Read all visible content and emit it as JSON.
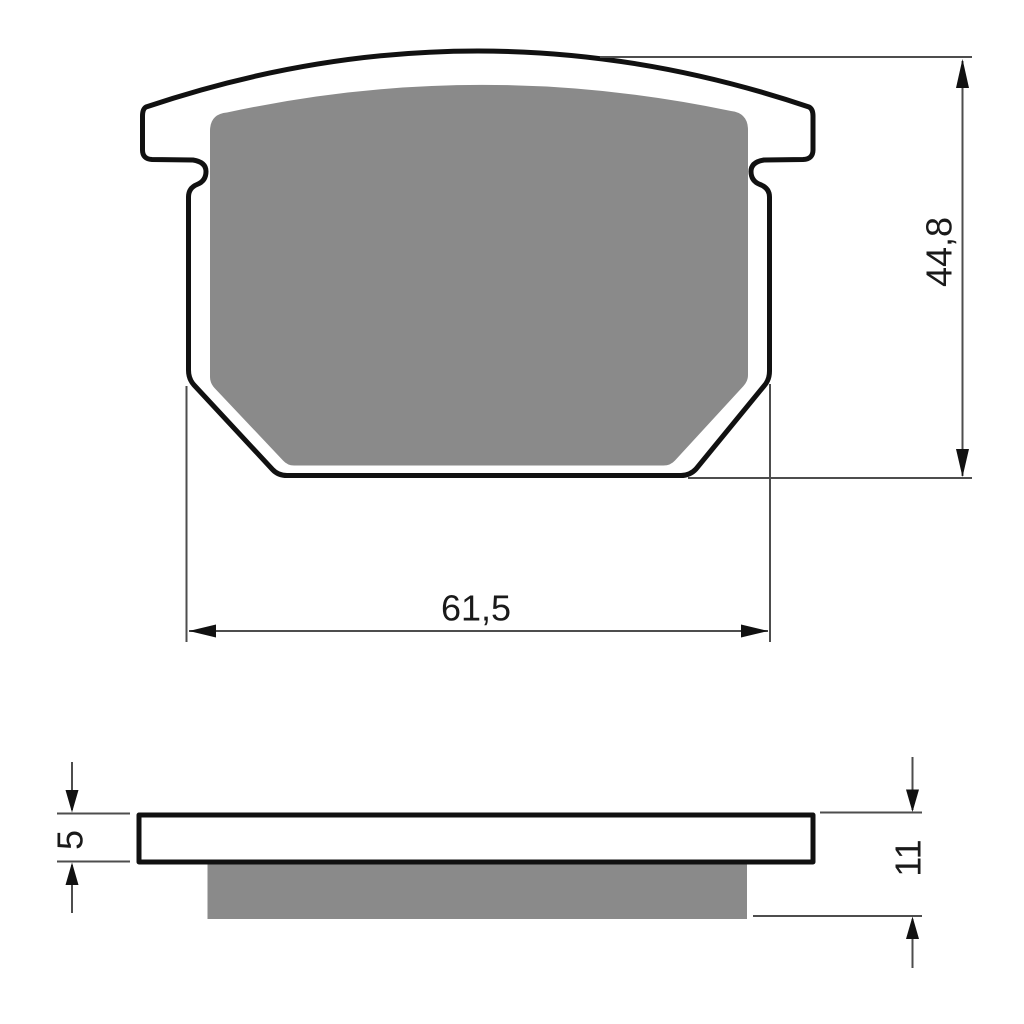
{
  "drawing": {
    "colors": {
      "outline": "#111111",
      "friction_material": "#8a8a8a",
      "backplate_fill": "#ffffff",
      "dimension_line": "#4d4d4d",
      "label_text": "#1a1a1a"
    },
    "front_view": {
      "dim_width": {
        "label": "61,5"
      },
      "dim_height": {
        "label": "44,8"
      }
    },
    "side_view": {
      "dim_backplate_thickness": {
        "label": "5"
      },
      "dim_total_thickness": {
        "label": "11"
      }
    }
  }
}
